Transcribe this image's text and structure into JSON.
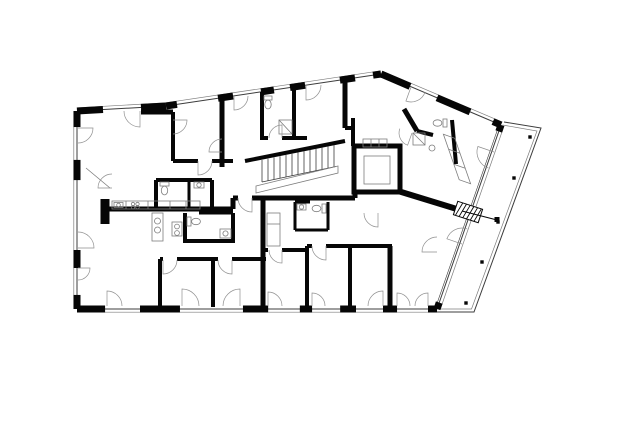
{
  "meta": {
    "width": 620,
    "height": 421,
    "bg": "#ffffff",
    "ink": "#060606",
    "line": "#3c3c3c",
    "faint": "#7d7d7d"
  },
  "plan": {
    "edges": [
      {
        "x1": 77,
        "y1": 111,
        "x2": 166,
        "y2": 106,
        "piers": [
          [
            0,
            0.292
          ],
          [
            0.719,
            1
          ]
        ]
      },
      {
        "x1": 166,
        "y1": 106,
        "x2": 381,
        "y2": 74,
        "piers": [
          [
            0,
            0.051
          ],
          [
            0.242,
            0.312
          ],
          [
            0.442,
            0.502
          ],
          [
            0.577,
            0.647
          ],
          [
            0.809,
            0.879
          ],
          [
            0.963,
            1
          ]
        ]
      },
      {
        "x1": 381,
        "y1": 74,
        "x2": 501,
        "y2": 125,
        "piers": [
          [
            0,
            0.242
          ],
          [
            0.467,
            0.742
          ],
          [
            0.933,
            1
          ]
        ]
      },
      {
        "x1": 501,
        "y1": 125,
        "x2": 437,
        "y2": 309,
        "glass": true,
        "piers": [
          [
            0,
            0.035
          ],
          [
            0.965,
            1
          ]
        ]
      },
      {
        "x1": 437,
        "y1": 309,
        "x2": 77,
        "y2": 309,
        "piers": [
          [
            0,
            0.025
          ],
          [
            0.111,
            0.15
          ],
          [
            0.225,
            0.269
          ],
          [
            0.347,
            0.381
          ],
          [
            0.469,
            0.539
          ],
          [
            0.714,
            0.825
          ],
          [
            0.922,
            1
          ]
        ]
      },
      {
        "x1": 77,
        "y1": 309,
        "x2": 77,
        "y2": 111,
        "piers": [
          [
            0,
            0.071
          ],
          [
            0.207,
            0.298
          ],
          [
            0.651,
            0.753
          ],
          [
            0.919,
            1
          ]
        ]
      }
    ],
    "balcony": {
      "outer": [
        504,
        122,
        541,
        128,
        474,
        312,
        437,
        312
      ],
      "inner": [
        502.5,
        125,
        537,
        131,
        471.5,
        309,
        437,
        309
      ],
      "dots": [
        [
          530,
          137
        ],
        [
          514,
          178
        ],
        [
          498,
          222
        ],
        [
          482,
          262
        ],
        [
          466,
          303
        ]
      ]
    },
    "walls": [
      [
        105,
        199,
        105,
        224,
        9
      ],
      [
        103,
        209,
        233,
        209,
        5
      ],
      [
        233,
        198,
        233,
        209,
        5
      ],
      [
        233,
        198,
        238,
        198,
        5
      ],
      [
        252,
        198,
        355,
        198,
        5
      ],
      [
        355,
        192,
        355,
        198,
        5
      ],
      [
        263,
        198,
        263,
        250,
        5
      ],
      [
        263,
        250,
        268,
        250,
        4
      ],
      [
        282,
        250,
        307,
        250,
        4
      ],
      [
        307,
        246,
        307,
        311,
        4
      ],
      [
        307,
        246,
        312,
        246,
        4
      ],
      [
        326,
        246,
        392,
        246,
        4
      ],
      [
        350,
        246,
        350,
        309,
        4
      ],
      [
        390,
        246,
        390,
        309,
        5
      ],
      [
        160,
        259,
        163,
        259,
        4
      ],
      [
        177,
        259,
        218,
        259,
        4
      ],
      [
        232,
        259,
        266,
        259,
        4
      ],
      [
        160,
        259,
        160,
        307,
        4
      ],
      [
        213,
        259,
        213,
        307,
        4
      ],
      [
        263,
        250,
        263,
        312,
        5
      ],
      [
        156,
        180,
        212,
        180,
        4
      ],
      [
        156,
        180,
        156,
        209,
        4
      ],
      [
        189,
        180,
        189,
        209,
        3
      ],
      [
        212,
        180,
        212,
        209,
        4
      ],
      [
        185,
        213,
        185,
        243,
        4
      ],
      [
        185,
        241,
        233,
        241,
        4
      ],
      [
        233,
        213,
        233,
        243,
        4
      ],
      [
        199,
        213,
        233,
        213,
        3
      ],
      [
        295,
        202,
        295,
        230,
        3
      ],
      [
        295,
        230,
        328,
        230,
        3
      ],
      [
        328,
        202,
        328,
        230,
        3
      ],
      [
        295,
        202,
        310,
        202,
        3
      ],
      [
        141,
        112,
        173,
        112,
        5
      ],
      [
        173,
        112,
        173,
        161,
        4
      ],
      [
        173,
        161,
        198,
        161,
        4
      ],
      [
        212,
        161,
        233,
        161,
        4
      ],
      [
        222,
        98,
        222,
        167,
        5
      ],
      [
        262,
        92,
        262,
        140,
        4
      ],
      [
        294,
        87,
        294,
        138,
        4
      ],
      [
        262,
        138,
        268,
        138,
        4
      ],
      [
        282,
        138,
        307,
        138,
        4
      ],
      [
        345,
        80,
        345,
        128,
        5
      ],
      [
        345,
        128,
        353,
        128,
        4
      ],
      [
        353,
        118,
        353,
        146,
        4
      ],
      [
        404,
        109,
        417,
        131,
        5
      ],
      [
        417,
        131,
        433,
        135,
        4
      ],
      [
        452,
        120,
        456,
        164,
        4
      ],
      [
        398,
        191,
        460,
        210,
        6
      ]
    ],
    "stairs": {
      "wall": [
        245,
        161,
        345,
        141
      ],
      "x1": 262,
      "x2": 336,
      "step": 6,
      "drop": 22,
      "slope": 0.21,
      "ytop": 160,
      "landing": [
        256,
        186,
        338,
        166,
        338,
        173,
        256,
        193
      ]
    },
    "elevator": {
      "outer": [
        354,
        146,
        46,
        46
      ],
      "inner": [
        364,
        156,
        26,
        28
      ],
      "shelf": [
        363,
        139,
        24,
        8
      ]
    },
    "doors": [
      [
        107,
        306,
        15,
        0,
        90
      ],
      [
        182,
        306,
        17,
        0,
        90
      ],
      [
        240,
        306,
        17,
        180,
        90
      ],
      [
        268,
        306,
        14,
        0,
        90
      ],
      [
        312,
        306,
        13,
        0,
        90
      ],
      [
        383,
        306,
        15,
        180,
        90
      ],
      [
        397,
        306,
        13,
        0,
        90
      ],
      [
        428,
        306,
        13,
        180,
        90
      ],
      [
        78,
        128,
        15,
        270,
        360
      ],
      [
        78,
        248,
        16,
        90,
        0
      ],
      [
        78,
        268,
        12,
        270,
        360
      ],
      [
        140,
        111,
        16,
        180,
        270
      ],
      [
        234,
        96,
        14,
        360,
        270
      ],
      [
        306,
        85,
        15,
        360,
        270
      ],
      [
        411,
        87,
        15,
        340,
        250
      ],
      [
        494,
        152,
        17,
        251,
        161
      ],
      [
        462,
        244,
        16,
        71,
        161
      ],
      [
        198,
        161,
        14,
        360,
        270
      ],
      [
        252,
        198,
        14,
        180,
        270
      ],
      [
        326,
        246,
        14,
        180,
        270
      ],
      [
        163,
        260,
        14,
        360,
        270
      ],
      [
        232,
        260,
        14,
        180,
        270
      ],
      [
        282,
        250,
        13,
        180,
        270
      ],
      [
        282,
        138,
        13,
        180,
        90
      ],
      [
        112,
        188,
        14,
        90,
        180
      ],
      [
        412,
        133,
        13,
        160,
        250
      ],
      [
        378,
        213,
        14,
        180,
        270
      ],
      [
        437,
        252,
        15,
        90,
        180
      ],
      [
        173,
        120,
        14,
        270,
        360
      ],
      [
        222,
        152,
        13,
        90,
        180
      ]
    ],
    "furnishings": [
      [
        "rect",
        112,
        201,
        88,
        8
      ],
      [
        "line",
        126,
        201,
        126,
        209
      ],
      [
        "line",
        148,
        201,
        148,
        209
      ],
      [
        "line",
        170,
        201,
        170,
        209
      ],
      [
        "line",
        186,
        201,
        186,
        209
      ],
      [
        "rect",
        114,
        202.5,
        9,
        5
      ],
      [
        "circle",
        118.5,
        205,
        1.8
      ],
      [
        "circle",
        133,
        204,
        1.7
      ],
      [
        "circle",
        137.5,
        204,
        1.7
      ],
      [
        "circle",
        133,
        207.2,
        1.7
      ],
      [
        "circle",
        137.5,
        207.2,
        1.7
      ],
      [
        "rect",
        152,
        213,
        11,
        28
      ],
      [
        "circle",
        157.5,
        221,
        3
      ],
      [
        "circle",
        157.5,
        230,
        3
      ],
      [
        "rect",
        172,
        222,
        10,
        14
      ],
      [
        "circle",
        177,
        226.5,
        2.4
      ],
      [
        "circle",
        177,
        233,
        2.4
      ],
      [
        "rect",
        267,
        213,
        13,
        33
      ],
      [
        "line",
        267,
        224,
        280,
        224
      ],
      [
        "poly",
        [
          443.4,
          134.3,
          454.8,
          138.3,
          470.6,
          183.7,
          459.2,
          179.7
        ]
      ],
      [
        "line",
        448.6,
        149.3,
        460,
        153.3
      ],
      [
        "line",
        453.8,
        164.3,
        465.2,
        168.3
      ],
      [
        "rect",
        160,
        182,
        9,
        4
      ],
      [
        "ellipse",
        164.5,
        190.5,
        3.2,
        4.4
      ],
      [
        "rect",
        194,
        182,
        10,
        6
      ],
      [
        "circle",
        199,
        185,
        2.2
      ],
      [
        "rect",
        187,
        217,
        4,
        9
      ],
      [
        "ellipse",
        196,
        221.5,
        4.4,
        3.2
      ],
      [
        "rect",
        220,
        229,
        11,
        9
      ],
      [
        "circle",
        225.5,
        233.5,
        2.6
      ],
      [
        "rect",
        322,
        204,
        4,
        9
      ],
      [
        "ellipse",
        316.5,
        208.5,
        4.4,
        3.2
      ],
      [
        "rect",
        297,
        204,
        9,
        6
      ],
      [
        "circle",
        301.5,
        207,
        2.2
      ],
      [
        "rect",
        264,
        96,
        8,
        4
      ],
      [
        "ellipse",
        268,
        104.5,
        3.2,
        4.4
      ],
      [
        "rect",
        279,
        120,
        13,
        14
      ],
      [
        "line",
        279,
        120,
        292,
        134
      ],
      [
        "rect",
        443,
        119,
        4,
        8
      ],
      [
        "ellipse",
        437.5,
        123,
        4.4,
        3.2
      ],
      [
        "circle",
        432,
        148,
        3
      ],
      [
        "rect",
        413,
        133,
        12,
        12
      ],
      [
        "line",
        413,
        133,
        425,
        145
      ],
      [
        "line",
        86,
        168,
        110,
        188
      ]
    ],
    "markers": {
      "hatch_poly": [
        457.8,
        201.3,
        482.6,
        209.3,
        478.2,
        222.7,
        453.4,
        214.7
      ],
      "hatch_lines": [
        [
          462.8,
          202.9,
          455.4,
          215.3
        ],
        [
          466.5,
          204.1,
          459.1,
          216.5
        ],
        [
          470.2,
          205.3,
          462.8,
          217.7
        ],
        [
          473.9,
          206.5,
          466.5,
          218.9
        ],
        [
          477.6,
          207.7,
          470.3,
          220.1
        ],
        [
          481.4,
          208.9,
          474,
          221.3
        ]
      ],
      "section_line": [
        462,
        211,
        497,
        220
      ],
      "section_dot": [
        494.5,
        217,
        5,
        5
      ]
    }
  }
}
